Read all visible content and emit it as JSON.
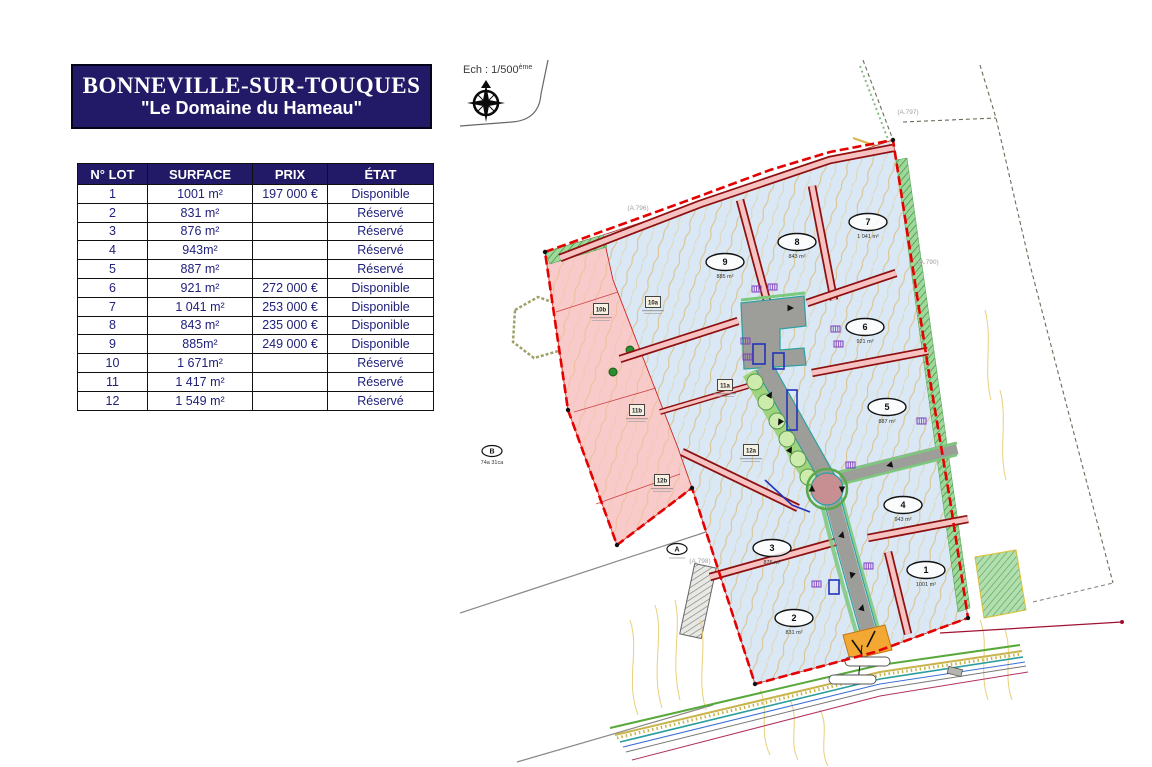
{
  "header": {
    "title": "BONNEVILLE-SUR-TOUQUES",
    "subtitle": "\"Le Domaine du Hameau\""
  },
  "table": {
    "columns": [
      "N° LOT",
      "SURFACE",
      "PRIX",
      "ÉTAT"
    ],
    "rows": [
      {
        "lot": "1",
        "surface": "1001 m²",
        "prix": "197 000 €",
        "etat": "Disponible"
      },
      {
        "lot": "2",
        "surface": "831 m²",
        "prix": "",
        "etat": "Réservé"
      },
      {
        "lot": "3",
        "surface": "876 m²",
        "prix": "",
        "etat": "Réservé"
      },
      {
        "lot": "4",
        "surface": "943m²",
        "prix": "",
        "etat": "Réservé"
      },
      {
        "lot": "5",
        "surface": "887 m²",
        "prix": "",
        "etat": "Réservé"
      },
      {
        "lot": "6",
        "surface": "921 m²",
        "prix": "272 000 €",
        "etat": "Disponible"
      },
      {
        "lot": "7",
        "surface": "1 041 m²",
        "prix": "253 000 €",
        "etat": "Disponible"
      },
      {
        "lot": "8",
        "surface": "843 m²",
        "prix": "235 000 €",
        "etat": "Disponible"
      },
      {
        "lot": "9",
        "surface": "885m²",
        "prix": "249 000 €",
        "etat": "Disponible"
      },
      {
        "lot": "10",
        "surface": "1 671m²",
        "prix": "",
        "etat": "Réservé"
      },
      {
        "lot": "11",
        "surface": "1 417 m²",
        "prix": "",
        "etat": "Réservé"
      },
      {
        "lot": "12",
        "surface": "1 549 m²",
        "prix": "",
        "etat": "Réservé"
      }
    ]
  },
  "map": {
    "scale_label": "Ech : 1/500",
    "scale_sup": "ème",
    "lot_markers": [
      {
        "n": "1",
        "area": "1001 m²",
        "x": 466,
        "y": 510
      },
      {
        "n": "2",
        "area": "831 m²",
        "x": 334,
        "y": 558
      },
      {
        "n": "3",
        "area": "876 m²",
        "x": 312,
        "y": 488
      },
      {
        "n": "4",
        "area": "943 m²",
        "x": 443,
        "y": 445
      },
      {
        "n": "5",
        "area": "887 m²",
        "x": 427,
        "y": 347
      },
      {
        "n": "6",
        "area": "921 m²",
        "x": 405,
        "y": 267
      },
      {
        "n": "7",
        "area": "1 041 m²",
        "x": 408,
        "y": 162
      },
      {
        "n": "8",
        "area": "843 m²",
        "x": 337,
        "y": 182
      },
      {
        "n": "9",
        "area": "885 m²",
        "x": 265,
        "y": 202
      }
    ],
    "sub_lots": [
      {
        "label": "10b",
        "x": 141,
        "y": 249
      },
      {
        "label": "10a",
        "x": 193,
        "y": 242
      },
      {
        "label": "11b",
        "x": 177,
        "y": 350
      },
      {
        "label": "12b",
        "x": 202,
        "y": 420
      },
      {
        "label": "11a",
        "x": 265,
        "y": 325
      },
      {
        "label": "12a",
        "x": 291,
        "y": 390
      }
    ],
    "parcel_refs": [
      {
        "label": "(A.797)",
        "x": 448,
        "y": 54
      },
      {
        "label": "(A.796)",
        "x": 178,
        "y": 150
      },
      {
        "label": "(A.790)",
        "x": 468,
        "y": 204
      },
      {
        "label": "(A.798)",
        "x": 240,
        "y": 503
      }
    ],
    "survey_points": [
      {
        "label": "B",
        "sub": "74a 31ca",
        "x": 32,
        "y": 391
      },
      {
        "label": "A",
        "sub": "",
        "x": 217,
        "y": 489
      }
    ]
  },
  "colors": {
    "navy": "#221a66",
    "table_text": "#20207c",
    "boundary_red": "#e60000",
    "lot_fill": "#d9e8f4",
    "reserved_pink": "#f8caca",
    "road_gray": "#9d9d9a",
    "green": "#6fbf5e"
  }
}
